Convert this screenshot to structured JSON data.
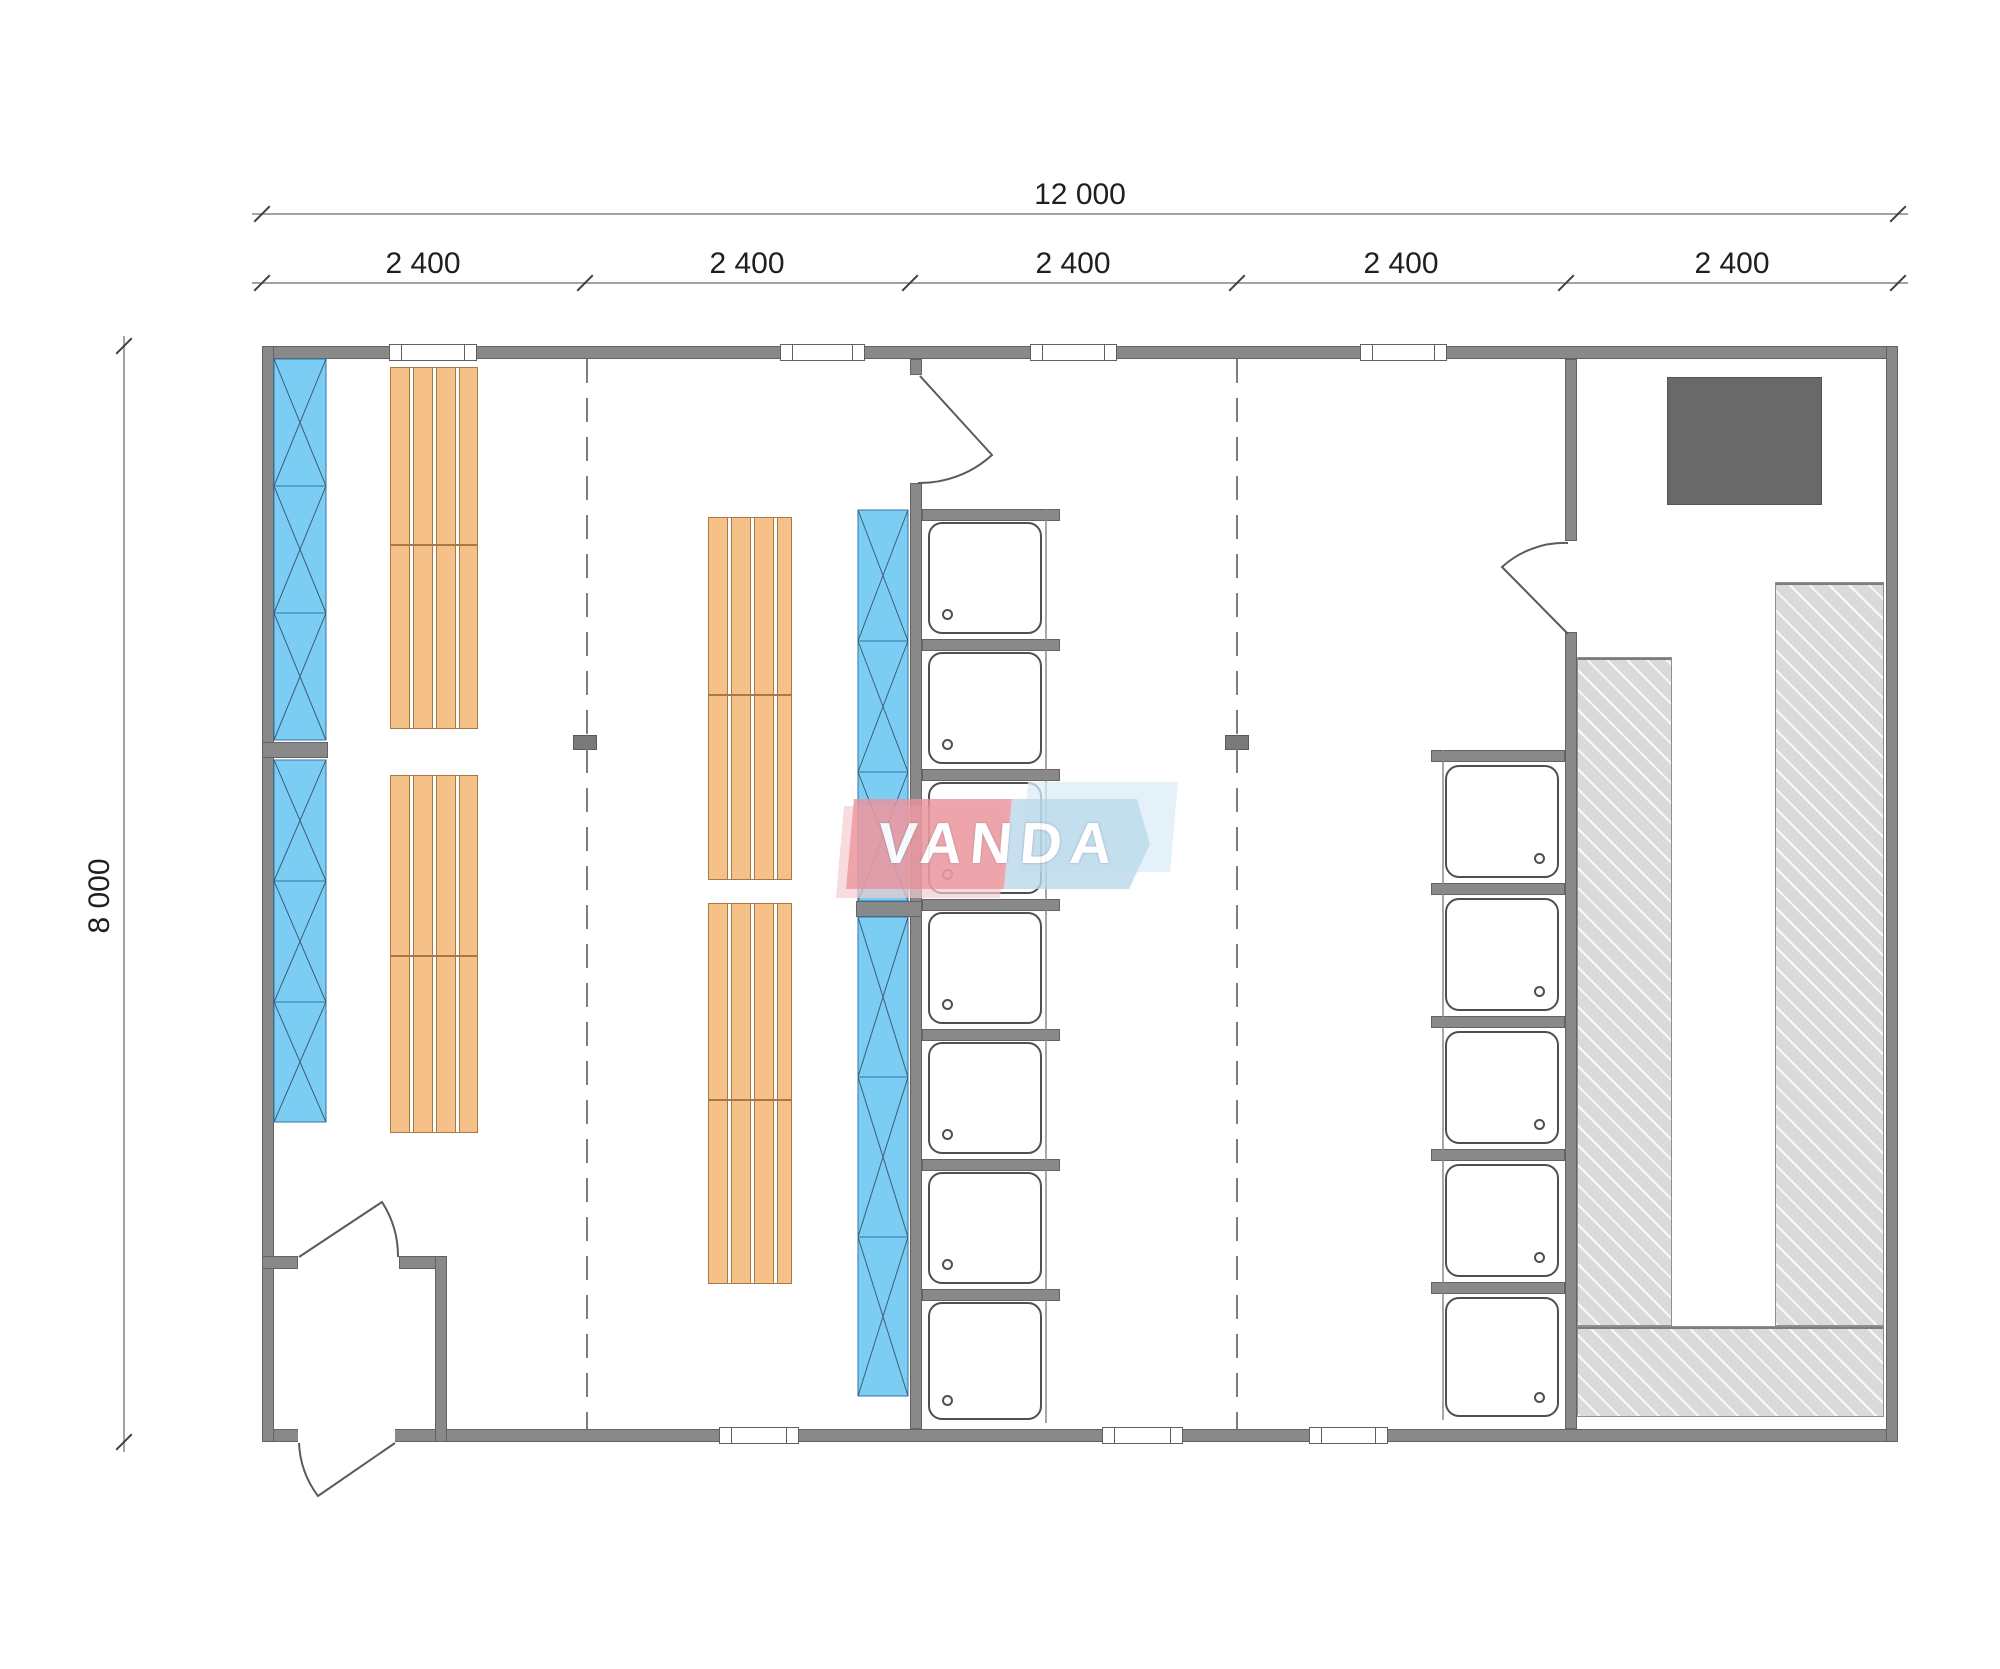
{
  "dimensions": {
    "overall_width_label": "12 000",
    "overall_height_label": "8 000",
    "module_labels": [
      "2 400",
      "2 400",
      "2 400",
      "2 400",
      "2 400"
    ]
  },
  "watermark": {
    "text": "VANDA",
    "red_hex": "#ea939c",
    "blue_hex": "#b9d8ea"
  },
  "fixtures": {
    "center_shower_stalls": 7,
    "right_shower_stalls": 5,
    "wood_bench_units": 8,
    "glazed_wall_sections": 4,
    "sauna_heaters": 1,
    "exterior_doors": 1,
    "interior_doors": 3,
    "top_wall_windows": 4,
    "bottom_wall_windows": 3,
    "structural_posts": 2
  },
  "colors": {
    "wall": "#898989",
    "glazing": "#7ccdf3",
    "wood_bench": "#f5c189",
    "tiled_bench": "#dadada",
    "heater": "#696969"
  }
}
